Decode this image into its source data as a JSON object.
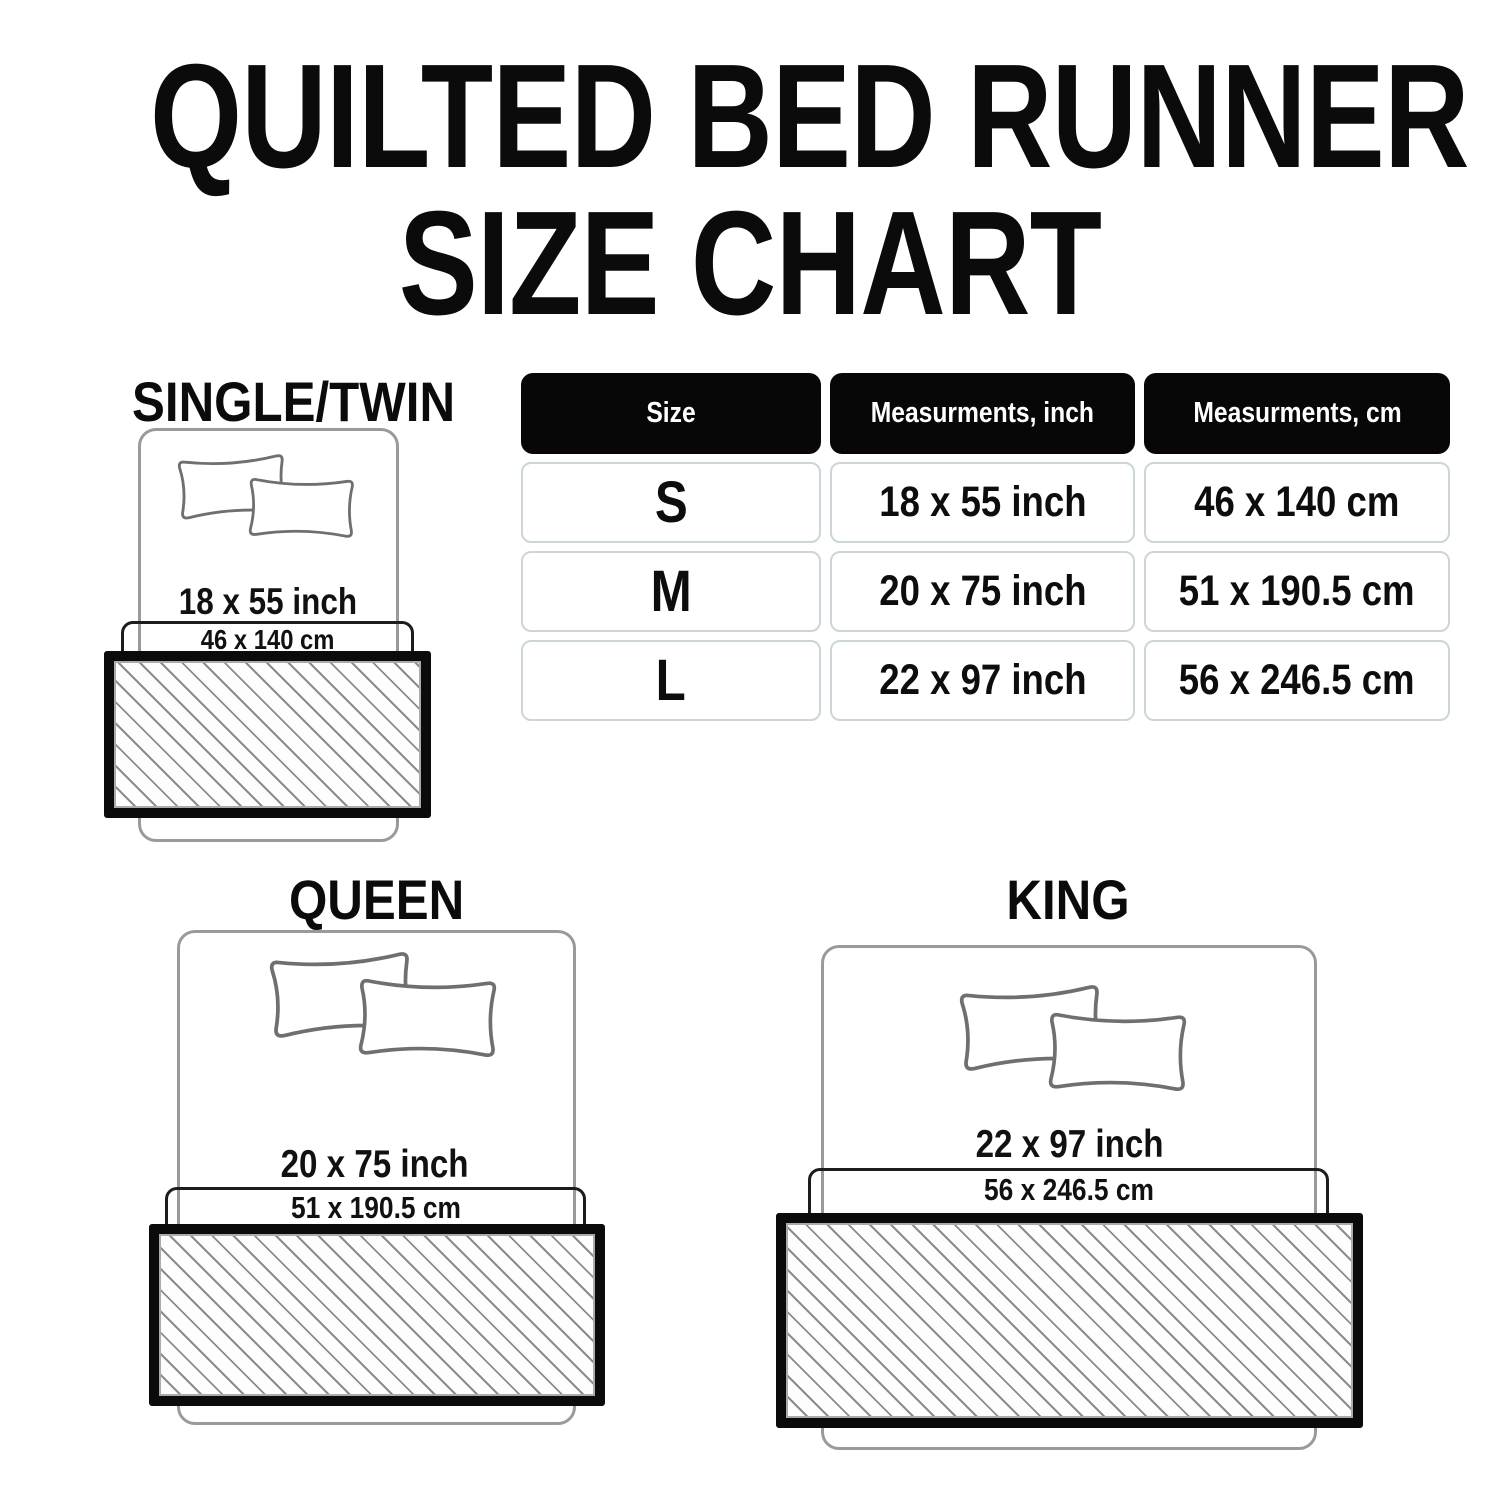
{
  "title": {
    "line1": "QUILTED BED RUNNER",
    "line2": "SIZE CHART"
  },
  "table": {
    "headers": [
      "Size",
      "Measurments, inch",
      "Measurments, cm"
    ],
    "rows": [
      {
        "size": "S",
        "inch": "18 x 55 inch",
        "cm": "46 x 140 cm"
      },
      {
        "size": "M",
        "inch": "20 x 75 inch",
        "cm": "51 x 190.5 cm"
      },
      {
        "size": "L",
        "inch": "22 x 97 inch",
        "cm": "56 x 246.5 cm"
      }
    ]
  },
  "sections": {
    "single": {
      "label": "SINGLE/TWIN",
      "inch": "18 x 55 inch",
      "cm": "46 x 140 cm"
    },
    "queen": {
      "label": "QUEEN",
      "inch": "20 x 75 inch",
      "cm": "51 x 190.5 cm"
    },
    "king": {
      "label": "KING",
      "inch": "22 x 97 inch",
      "cm": "56 x 246.5 cm"
    }
  },
  "colors": {
    "text": "#0d0d0d",
    "table_header_bg": "#070707",
    "table_header_text": "#ffffff",
    "table_cell_border": "#ccd5d8",
    "bed_outline": "#9a9a9a",
    "pillow_outline": "#6f6f6f",
    "hatch_line": "#8c8c8c",
    "runner_border": "#0b0b0b"
  }
}
